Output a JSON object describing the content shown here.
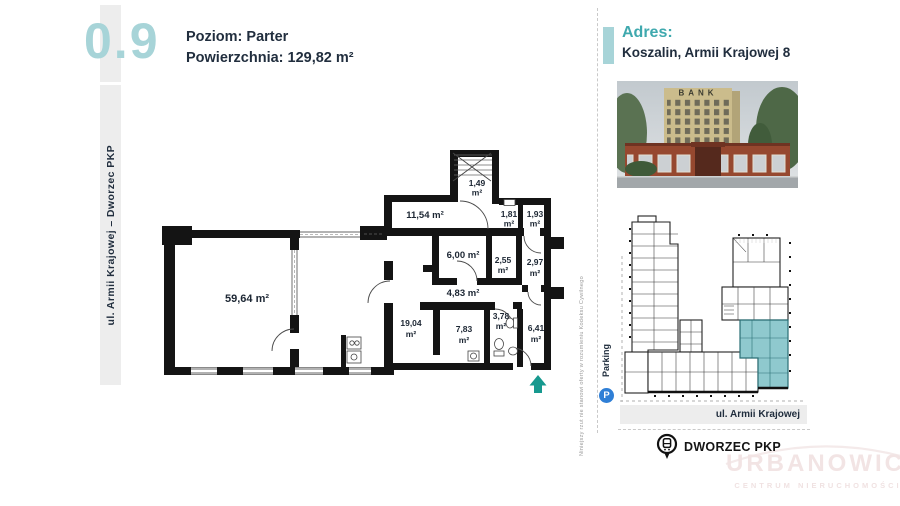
{
  "header": {
    "unit_number": "0.9",
    "level": "Poziom: Parter",
    "area_label": "Powierzchnia:",
    "area_value": "129,82 m²"
  },
  "left_strip_label": "ul. Armii Krajowej – Dworzec PKP",
  "floor_plan": {
    "rooms": [
      {
        "label": "59,64 m²",
        "num": "59,64",
        "unit": "m²"
      },
      {
        "label": "11,54 m²",
        "num": "11,54",
        "unit": "m²"
      },
      {
        "label": "1,49 m²",
        "num": "1,49",
        "unit": "m²"
      },
      {
        "label": "1,81 m²",
        "num": "1,81",
        "unit": "m²"
      },
      {
        "label": "1,93 m²",
        "num": "1,93",
        "unit": "m²"
      },
      {
        "label": "6,00 m²",
        "num": "6,00",
        "unit": "m²"
      },
      {
        "label": "2,55 m²",
        "num": "2,55",
        "unit": "m²"
      },
      {
        "label": "2,97 m²",
        "num": "2,97",
        "unit": "m²"
      },
      {
        "label": "4,83 m²",
        "num": "4,83",
        "unit": "m²"
      },
      {
        "label": "19,04 m²",
        "num": "19,04",
        "unit": "m²"
      },
      {
        "label": "7,83 m²",
        "num": "7,83",
        "unit": "m²"
      },
      {
        "label": "3,78 m²",
        "num": "3,78",
        "unit": "m²"
      },
      {
        "label": "6,41 m²",
        "num": "6,41",
        "unit": "m²"
      }
    ],
    "disclaimer": "Niniejszy rzut nie stanowi oferty w rozumieniu Kodeksu Cywilnego"
  },
  "address": {
    "label": "Adres:",
    "value": "Koszalin, Armii Krajowej 8"
  },
  "photo": {
    "sign": "BANK"
  },
  "site_plan": {
    "street": "ul. Armii Krajowej",
    "parking": "Parking",
    "parking_symbol": "P"
  },
  "transport": {
    "label": "DWORZEC PKP"
  },
  "watermark": {
    "line1": "URBANOWICZ",
    "line2": "CENTRUM NIERUCHOMOŚCI"
  },
  "colors": {
    "teal_light": "#a7d4d8",
    "teal": "#3fa9ae",
    "teal_arrow": "#17998f",
    "navy": "#212e3e",
    "site_highlight": "#8fc9ce",
    "parking_blue": "#2f7fd6",
    "watermark_pink": "#f2e4e4"
  }
}
